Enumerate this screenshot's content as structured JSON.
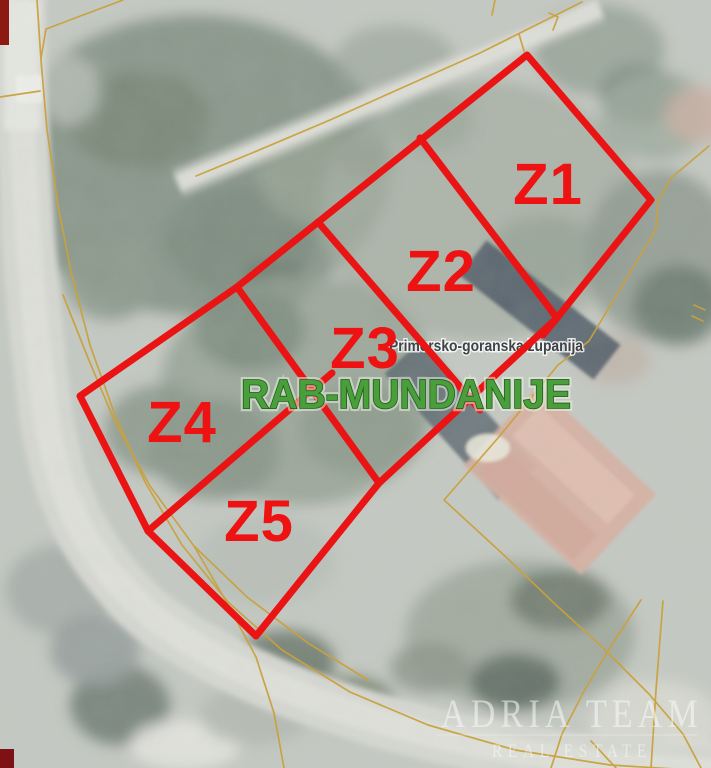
{
  "map": {
    "region_label": "Primorsko-goranska županija",
    "place_label": "RAB-MUNDANIJE",
    "parcels": [
      {
        "id": "Z1"
      },
      {
        "id": "Z2"
      },
      {
        "id": "Z3"
      },
      {
        "id": "Z4"
      },
      {
        "id": "Z5"
      }
    ],
    "colors": {
      "parcel_outline": "#ea1414",
      "parcel_label": "#ee1212",
      "place_label_fill": "#4a9e3b",
      "place_label_outline": "#1c5a17",
      "region_label": "#3f4347",
      "cadastral_line": "#c9a13d",
      "watermark": "rgba(248,249,250,0.55)"
    },
    "watermark": {
      "line1": "ADRIA TEAM",
      "line2": "REAL ESTATE"
    }
  }
}
